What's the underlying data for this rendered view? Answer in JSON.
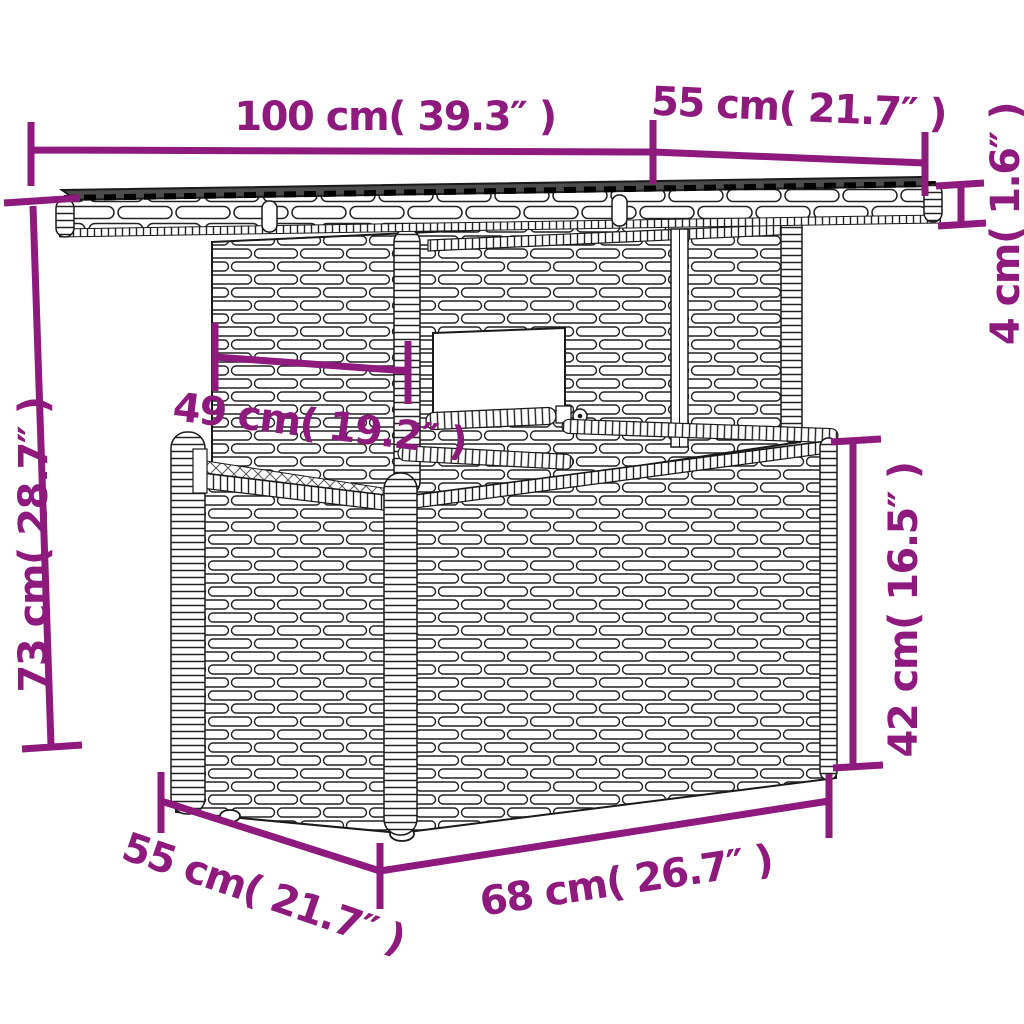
{
  "page": {
    "background": "#ffffff"
  },
  "diagram": {
    "subject": "poly-rattan garden table dimension drawing",
    "accent_color": "#8e1a7d",
    "line_color": "#1a1a1a",
    "tabletop_color": "#4c4c4c",
    "labels": {
      "top_width": "100 cm( 39.3″ )",
      "top_depth": "55 cm( 21.7″ )",
      "top_thickness": "4 cm( 1.6″ )",
      "total_height": "73 cm( 28.7″ )",
      "pedestal_depth": "49 cm( 19.2″ )",
      "base_height": "42 cm( 16.5″ )",
      "base_depth": "55 cm( 21.7″ )",
      "base_width": "68 cm( 26.7″ )"
    }
  }
}
